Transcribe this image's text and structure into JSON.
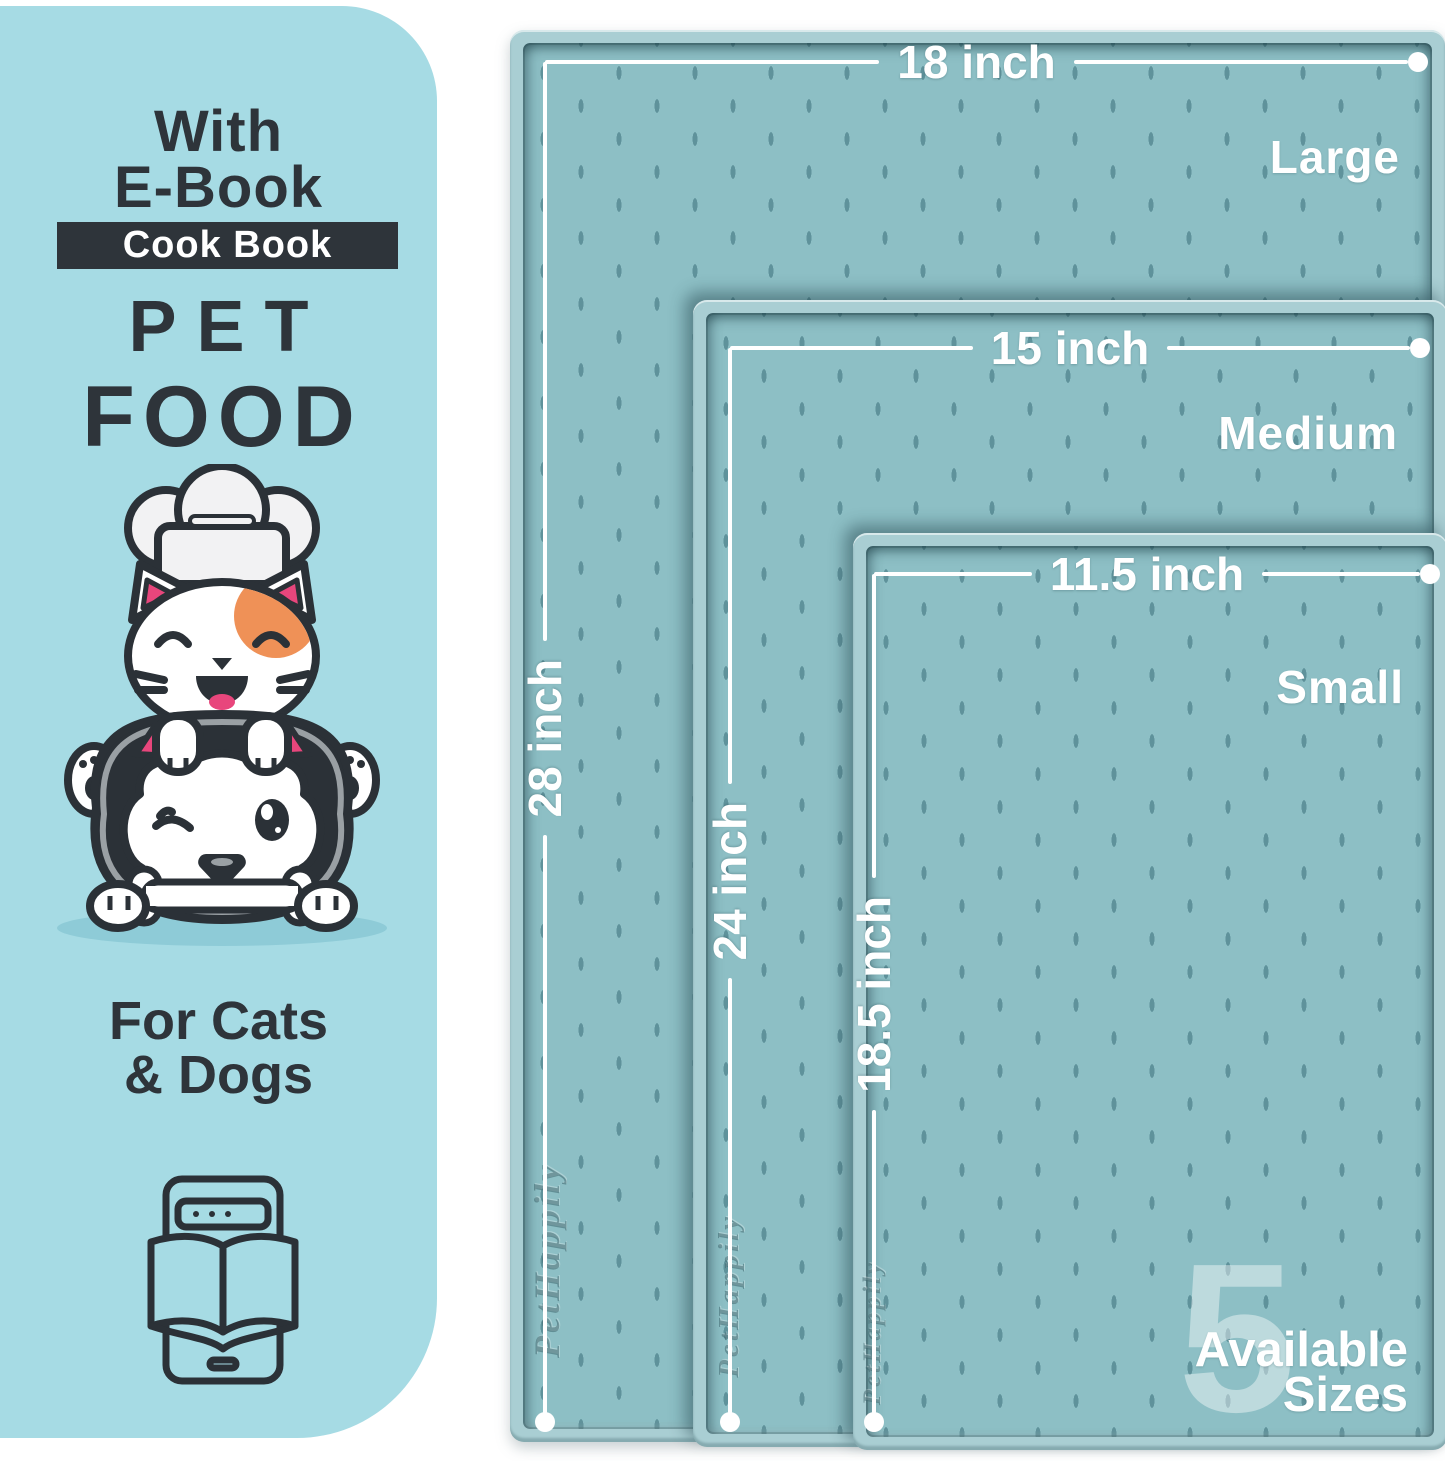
{
  "panel": {
    "line1": "With",
    "line2": "E-Book",
    "badge": "Cook Book",
    "title_line1": "PET",
    "title_line2": "FOOD",
    "audience_line1": "For Cats",
    "audience_line2": "& Dogs"
  },
  "mats": [
    {
      "name": "Large",
      "width_label": "18 inch",
      "height_label": "28 inch"
    },
    {
      "name": "Medium",
      "width_label": "15 inch",
      "height_label": "24 inch"
    },
    {
      "name": "Small",
      "width_label": "11.5 inch",
      "height_label": "18.5 inch"
    }
  ],
  "watermark": "PetHappily",
  "sizes_badge": {
    "number": "5",
    "line1": "Available",
    "line2": "Sizes"
  },
  "colors": {
    "panel_bg": "#a6dbe4",
    "ink": "#2e343a",
    "mat_rim": "#a9ced3",
    "mat_surface": "#8dbfc5",
    "mat_dash": "#5f929b",
    "accent_pink": "#e8467c",
    "accent_orange": "#ef9157",
    "dimension_line": "#ffffff"
  }
}
